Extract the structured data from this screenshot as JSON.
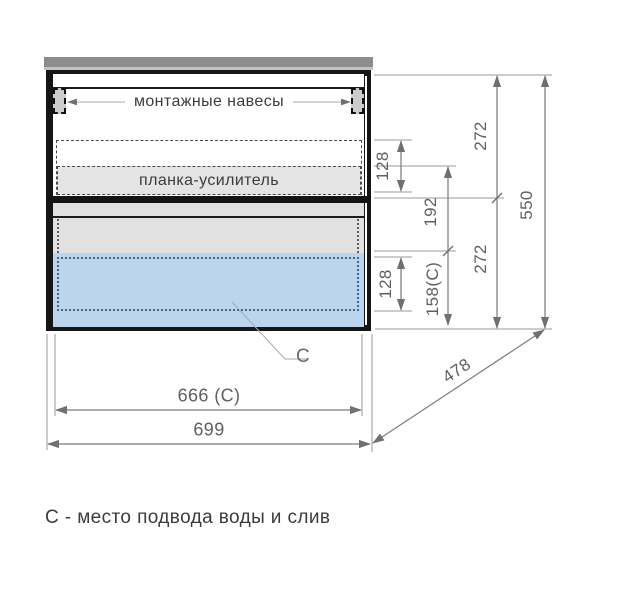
{
  "drawing": {
    "labels": {
      "mounting_hangers": "монтажные навесы",
      "reinforcement_bar": "планка-усилитель",
      "c_marker": "C",
      "caption": "С - место подвода воды и слив"
    },
    "dimensions": {
      "hang_zone_height": "128",
      "upper_section_height": "272",
      "total_height": "550",
      "mid_offset": "192",
      "c_zone_height": "158(C)",
      "c_inner_height": "128",
      "lower_section_height": "272",
      "inner_width": "666 (C)",
      "total_width": "699",
      "depth": "478"
    },
    "colors": {
      "c_zone_fill": "#bcd5ee",
      "panel_gray": "#e4e4e4",
      "top_panel_gray": "#8c8c8c",
      "line_gray": "#8f8f8f"
    }
  }
}
